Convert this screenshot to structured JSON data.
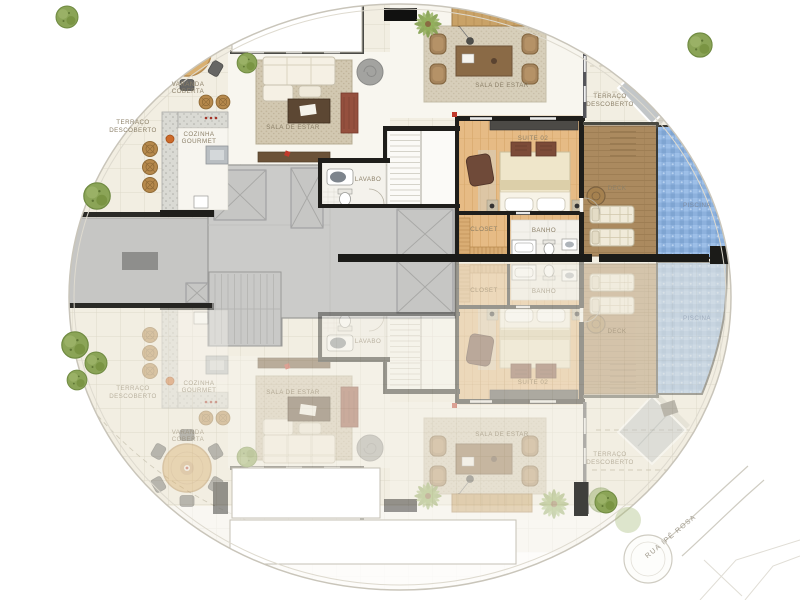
{
  "labels": {
    "varanda": {
      "l1": "VARANDA",
      "l2": "COBERTA"
    },
    "terraco": {
      "l1": "TERRAÇO",
      "l2": "DESCOBERTO"
    },
    "cozinha": {
      "l1": "COZINHA",
      "l2": "GOURMET"
    },
    "sala": "SALA DE ESTAR",
    "lavabo": "LAVABO",
    "suite": "SUITE 02",
    "closet": "CLOSET",
    "banho": "BANHO",
    "deck": "DECK",
    "piscina": "PISCINA",
    "rua": "RUA IPÊ ROSA"
  },
  "colors": {
    "wall": "#1f1e1b",
    "terrace_tile": "#f2eee2",
    "interior_floor": "#f8f6ef",
    "suite_wood": "#e6bb85",
    "deck_wood": "#ad8c62",
    "pool_water": "#8fb3de",
    "core_gray": "#cbcbc9",
    "vegetation": "#8ba457",
    "label_text": "#8c8069",
    "pool_label_text": "#7e8ca2",
    "door_accent": "#c0392b",
    "street_line": "#cfccc2"
  }
}
